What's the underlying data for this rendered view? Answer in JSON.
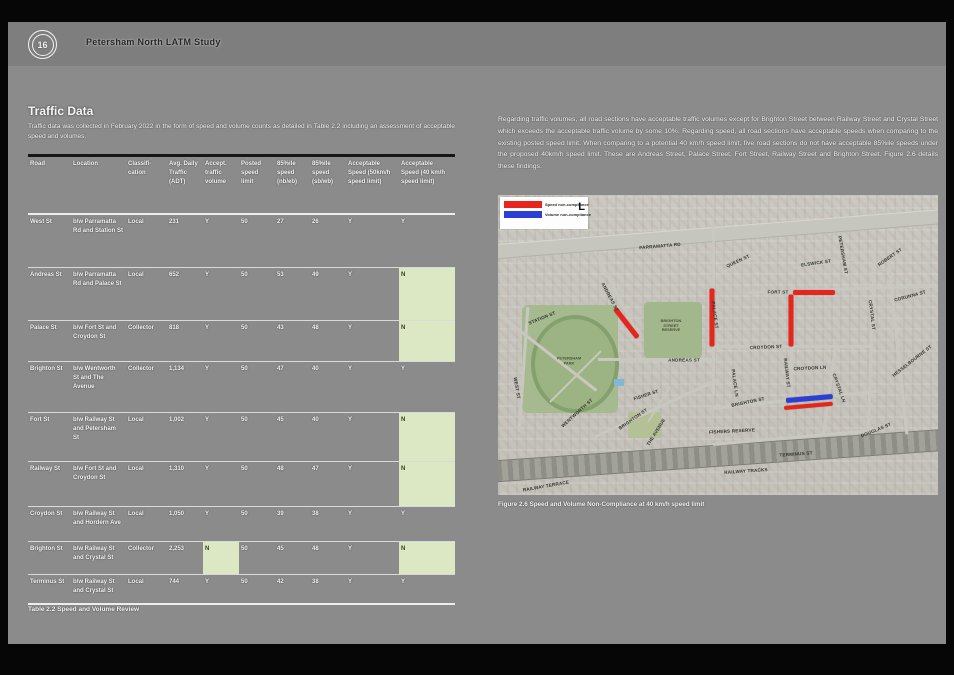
{
  "header": {
    "page_number": "16",
    "title": "Petersham North LATM Study"
  },
  "left": {
    "heading": "Traffic Data",
    "intro": "Traffic data was collected in February 2022 in the form of speed and volume counts as detailed in Table 2.2 including an assessment of acceptable speed and volumes.",
    "table_caption": "Table 2.2 Speed and Volume Review"
  },
  "table": {
    "columns": [
      {
        "key": "road",
        "label": "Road"
      },
      {
        "key": "location",
        "label": "Location"
      },
      {
        "key": "classification",
        "label": "Classifi- cation"
      },
      {
        "key": "adt",
        "label": "Avg. Daily Traffic (ADT)"
      },
      {
        "key": "accept_volume",
        "label": "Accept. traffic volume"
      },
      {
        "key": "posted_limit",
        "label": "Posted speed limit"
      },
      {
        "key": "speed_nb",
        "label": "85%ile speed (nb/eb)"
      },
      {
        "key": "speed_sb",
        "label": "85%ile speed (sb/wb)"
      },
      {
        "key": "accept_50",
        "label": "Acceptable Speed (50km/h speed limit)"
      },
      {
        "key": "accept_40",
        "label": "Acceptable Speed (40 km/h speed limit)"
      }
    ],
    "rows": [
      {
        "road": "West St",
        "location": "b/w Parramatta Rd and Station St",
        "classification": "Local",
        "adt": "231",
        "accept_volume": "Y",
        "posted_limit": "50",
        "speed_nb": "27",
        "speed_sb": "26",
        "accept_50": "Y",
        "accept_40": "Y",
        "highlights": []
      },
      {
        "road": "Andreas St",
        "location": "b/w Parramatta Rd and Palace St",
        "classification": "Local",
        "adt": "652",
        "accept_volume": "Y",
        "posted_limit": "50",
        "speed_nb": "53",
        "speed_sb": "49",
        "accept_50": "Y",
        "accept_40": "N",
        "highlights": [
          "accept_40"
        ]
      },
      {
        "road": "Palace St",
        "location": "b/w Fort St and Croydon St",
        "classification": "Collector",
        "adt": "818",
        "accept_volume": "Y",
        "posted_limit": "50",
        "speed_nb": "43",
        "speed_sb": "48",
        "accept_50": "Y",
        "accept_40": "N",
        "highlights": [
          "accept_40"
        ]
      },
      {
        "road": "Brighton St",
        "location": "b/w Wentworth St and The Avenue",
        "classification": "Collector",
        "adt": "1,134",
        "accept_volume": "Y",
        "posted_limit": "50",
        "speed_nb": "47",
        "speed_sb": "40",
        "accept_50": "Y",
        "accept_40": "Y",
        "highlights": []
      },
      {
        "road": "Fort St",
        "location": "b/w Railway St and Petersham St",
        "classification": "Local",
        "adt": "1,002",
        "accept_volume": "Y",
        "posted_limit": "50",
        "speed_nb": "45",
        "speed_sb": "40",
        "accept_50": "Y",
        "accept_40": "N",
        "highlights": [
          "accept_40"
        ]
      },
      {
        "road": "Railway St",
        "location": "b/w Fort St and Croydon St",
        "classification": "Local",
        "adt": "1,310",
        "accept_volume": "Y",
        "posted_limit": "50",
        "speed_nb": "48",
        "speed_sb": "47",
        "accept_50": "Y",
        "accept_40": "N",
        "highlights": [
          "accept_40"
        ]
      },
      {
        "road": "Croydon St",
        "location": "b/w Railway St and Hordern Ave",
        "classification": "Local",
        "adt": "1,050",
        "accept_volume": "Y",
        "posted_limit": "50",
        "speed_nb": "39",
        "speed_sb": "38",
        "accept_50": "Y",
        "accept_40": "Y",
        "highlights": []
      },
      {
        "road": "Brighton St",
        "location": "b/w Railway St and Crystal St",
        "classification": "Collector",
        "adt": "2,253",
        "accept_volume": "N",
        "posted_limit": "50",
        "speed_nb": "45",
        "speed_sb": "48",
        "accept_50": "Y",
        "accept_40": "N",
        "highlights": [
          "accept_volume",
          "accept_40"
        ]
      },
      {
        "road": "Terminus St",
        "location": "b/w Railway St and Crystal St",
        "classification": "Local",
        "adt": "744",
        "accept_volume": "Y",
        "posted_limit": "50",
        "speed_nb": "42",
        "speed_sb": "38",
        "accept_50": "Y",
        "accept_40": "Y",
        "highlights": []
      }
    ]
  },
  "right": {
    "paragraph": "Regarding traffic volumes, all road sections have acceptable traffic volumes except for Brighton Street between Railway Street and Crystal Street which exceeds the acceptable traffic volume by some 10%. Regarding speed, all road sections have acceptable speeds when comparing to the existing posted speed limit. When comparing to a potential 40 km/h speed limit, five road sections do not have acceptable 85%ile speeds under the proposed 40km/h speed limit. These are Andreas Street, Palace Street, Fort Street, Railway Street and Brighton Street. Figure 2.6 details these findings.",
    "figure_caption": "Figure 2.6 Speed and Volume Non-Compliance at 40 km/h speed limit"
  },
  "map": {
    "legend": [
      {
        "label": "Speed non-compliance",
        "color": "#e8251d"
      },
      {
        "label": "Volume non-compliance",
        "color": "#2b3fd4"
      }
    ],
    "legend_mark": "L",
    "street_labels": [
      {
        "text": "PARRAMATTA RD",
        "x": 162,
        "y": 51,
        "rot": -5
      },
      {
        "text": "QUEEN ST",
        "x": 240,
        "y": 66,
        "rot": -25
      },
      {
        "text": "ELSWICK ST",
        "x": 318,
        "y": 68,
        "rot": -8
      },
      {
        "text": "PETERSHAM ST",
        "x": 345,
        "y": 60,
        "rot": 80
      },
      {
        "text": "ROBERT ST",
        "x": 392,
        "y": 62,
        "rot": -35
      },
      {
        "text": "CORUNNA ST",
        "x": 412,
        "y": 101,
        "rot": -15
      },
      {
        "text": "FORT ST",
        "x": 280,
        "y": 97,
        "rot": 0
      },
      {
        "text": "STATION ST",
        "x": 44,
        "y": 123,
        "rot": -22
      },
      {
        "text": "ANDREAS ST",
        "x": 112,
        "y": 102,
        "rot": 62
      },
      {
        "text": "ANDREAS ST",
        "x": 186,
        "y": 165,
        "rot": 0
      },
      {
        "text": "PALACE ST",
        "x": 217,
        "y": 120,
        "rot": 82
      },
      {
        "text": "PALACE LN",
        "x": 237,
        "y": 188,
        "rot": 82
      },
      {
        "text": "CROYDON ST",
        "x": 268,
        "y": 152,
        "rot": -2
      },
      {
        "text": "CROYDON LN",
        "x": 312,
        "y": 173,
        "rot": -3
      },
      {
        "text": "RAILWAY ST",
        "x": 289,
        "y": 178,
        "rot": 83
      },
      {
        "text": "CRYSTAL ST",
        "x": 374,
        "y": 120,
        "rot": 83
      },
      {
        "text": "CRYSTAL LN",
        "x": 341,
        "y": 193,
        "rot": 70
      },
      {
        "text": "HESSELBOURNE ST",
        "x": 414,
        "y": 166,
        "rot": -38
      },
      {
        "text": "BRIGHTON ST",
        "x": 250,
        "y": 207,
        "rot": -12
      },
      {
        "text": "BRIGHTON ST",
        "x": 135,
        "y": 224,
        "rot": -35
      },
      {
        "text": "WENTWORTH ST",
        "x": 79,
        "y": 218,
        "rot": -42
      },
      {
        "text": "WEST ST",
        "x": 19,
        "y": 193,
        "rot": 80
      },
      {
        "text": "FISHER ST",
        "x": 148,
        "y": 200,
        "rot": -18
      },
      {
        "text": "THE AVENUE",
        "x": 158,
        "y": 237,
        "rot": -58
      },
      {
        "text": "FISHERS RESERVE",
        "x": 234,
        "y": 236,
        "rot": -3
      },
      {
        "text": "TERMINUS ST",
        "x": 298,
        "y": 259,
        "rot": -4
      },
      {
        "text": "RAILWAY TRACKS",
        "x": 248,
        "y": 276,
        "rot": -4
      },
      {
        "text": "RAILWAY TERRACE",
        "x": 48,
        "y": 291,
        "rot": -10
      },
      {
        "text": "DOUGLAS ST",
        "x": 378,
        "y": 235,
        "rot": -22
      }
    ],
    "area_labels": [
      {
        "text": "PETERSHAM PARK",
        "x": 71,
        "y": 166,
        "w": 34
      },
      {
        "text": "BRIGHTON STREET RESERVE",
        "x": 173,
        "y": 131,
        "w": 28
      }
    ],
    "annotations": [
      {
        "street": "Andreas St",
        "measure": "speed",
        "color": "#e8251d",
        "x": 117,
        "y": 111,
        "len": 37,
        "rot": 52,
        "thick": 5
      },
      {
        "street": "Palace St",
        "measure": "speed",
        "color": "#e8251d",
        "x": 214,
        "y": 91,
        "len": 58,
        "rot": 90,
        "thick": 5
      },
      {
        "street": "Fort St",
        "measure": "speed",
        "color": "#e8251d",
        "x": 295,
        "y": 95,
        "len": 42,
        "rot": 0,
        "thick": 5
      },
      {
        "street": "Railway St",
        "measure": "speed",
        "color": "#e8251d",
        "x": 293,
        "y": 97,
        "len": 52,
        "rot": 90,
        "thick": 5
      },
      {
        "street": "Brighton St",
        "measure": "volume",
        "color": "#2b3fd4",
        "x": 288,
        "y": 203,
        "len": 47,
        "rot": -5,
        "thick": 5
      },
      {
        "street": "Brighton St",
        "measure": "speed",
        "color": "#e8251d",
        "x": 286,
        "y": 211,
        "len": 49,
        "rot": -5,
        "thick": 4
      }
    ]
  }
}
